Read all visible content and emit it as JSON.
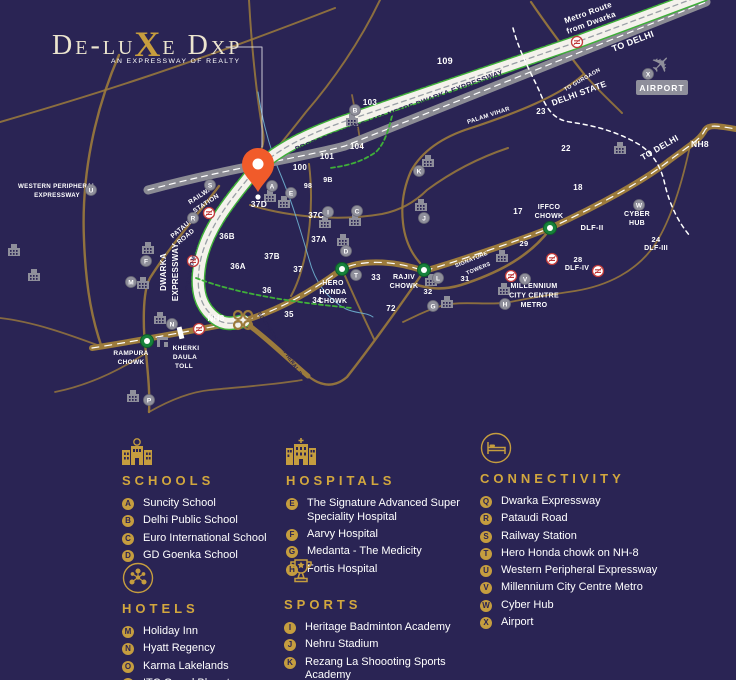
{
  "logo": {
    "part1": "De-lu",
    "accent": "X",
    "part2": "e Dxp",
    "tagline": "AN EXPRESSWAY OF REALTY"
  },
  "legend": {
    "sections": [
      {
        "id": "schools",
        "icon": "school-icon",
        "title": "SCHOOLS",
        "items": [
          {
            "letter": "A",
            "label": "Suncity School"
          },
          {
            "letter": "B",
            "label": "Delhi Public School"
          },
          {
            "letter": "C",
            "label": "Euro International School"
          },
          {
            "letter": "D",
            "label": "GD Goenka School"
          }
        ]
      },
      {
        "id": "hospitals",
        "icon": "hospital-icon",
        "title": "HOSPITALS",
        "items": [
          {
            "letter": "E",
            "label": "The Signature Advanced Super Speciality Hospital"
          },
          {
            "letter": "F",
            "label": "Aarvy Hospital"
          },
          {
            "letter": "G",
            "label": "Medanta - The Medicity"
          },
          {
            "letter": "H",
            "label": "Fortis Hospital"
          }
        ]
      },
      {
        "id": "connectivity",
        "icon": "bed-icon",
        "title": "CONNECTIVITY",
        "items": [
          {
            "letter": "Q",
            "label": "Dwarka Expressway"
          },
          {
            "letter": "R",
            "label": "Pataudi Road"
          },
          {
            "letter": "S",
            "label": "Railway Station"
          },
          {
            "letter": "T",
            "label": "Hero Honda chowk on NH-8"
          },
          {
            "letter": "U",
            "label": "Western Peripheral Expressway"
          },
          {
            "letter": "V",
            "label": "Millennium City Centre Metro"
          },
          {
            "letter": "W",
            "label": "Cyber Hub"
          },
          {
            "letter": "X",
            "label": "Airport"
          }
        ]
      },
      {
        "id": "hotels",
        "icon": "network-icon",
        "title": "HOTELS",
        "items": [
          {
            "letter": "M",
            "label": "Holiday Inn"
          },
          {
            "letter": "N",
            "label": "Hyatt Regency"
          },
          {
            "letter": "O",
            "label": "Karma Lakelands"
          },
          {
            "letter": "P",
            "label": "ITC Grand Bharat"
          }
        ]
      },
      {
        "id": "sports",
        "icon": "trophy-icon",
        "title": "SPORTS",
        "items": [
          {
            "letter": "I",
            "label": "Heritage Badminton Academy"
          },
          {
            "letter": "J",
            "label": "Nehru Stadium"
          },
          {
            "letter": "K",
            "label": "Rezang La Shoooting Sports Academy"
          },
          {
            "letter": "L",
            "label": "Tau Devi Lal Sports Complex"
          }
        ]
      }
    ]
  },
  "map": {
    "colors": {
      "background": "#2a2454",
      "gold_road": "#9c7b3c",
      "accent_gold": "#c59d3f",
      "heading_gold": "#d2a73e",
      "white_road": "#f4f2ec",
      "grey_road": "#8b8b94",
      "green_dash": "#3faf39",
      "pin_orange": "#f15b2a",
      "metro_red": "#c03a3a",
      "marker_grey": "#8f8f9b",
      "navy_text": "#2a2454",
      "rail_blue": "#6fb3d2",
      "node_green": "#17823b",
      "white": "#ffffff"
    },
    "pin": {
      "x": 258,
      "y": 166,
      "label": "37D"
    },
    "airport": {
      "x": 662,
      "y": 88,
      "label": "AIRPORT"
    },
    "labels": [
      {
        "t": "Metro Route",
        "x": 589,
        "y": 15,
        "r": -20,
        "s": 8
      },
      {
        "t": "from Dwarka",
        "x": 592,
        "y": 25,
        "r": -20,
        "s": 8
      },
      {
        "t": "TO DELHI",
        "x": 634,
        "y": 44,
        "r": -21,
        "s": 9
      },
      {
        "t": "TO GURGAON",
        "x": 583,
        "y": 81,
        "r": -30,
        "s": 5.5
      },
      {
        "t": "DELHI STATE",
        "x": 580,
        "y": 96,
        "r": -20,
        "s": 8.5
      },
      {
        "t": "PALAM VIHAR",
        "x": 489,
        "y": 117,
        "r": -18,
        "s": 6
      },
      {
        "t": "PROPOSED METRO / 150 METRE DWARKA EXPRESSWAY",
        "x": 400,
        "y": 113,
        "r": -20.5,
        "s": 7.5,
        "c": "n"
      },
      {
        "t": "TO DELHI",
        "x": 661,
        "y": 150,
        "r": -30,
        "s": 8.5
      },
      {
        "t": "NH8",
        "x": 700,
        "y": 147,
        "s": 8.5
      },
      {
        "t": "109",
        "x": 445,
        "y": 64,
        "s": 9
      },
      {
        "t": "23",
        "x": 541,
        "y": 114,
        "s": 8
      },
      {
        "t": "22",
        "x": 566,
        "y": 151,
        "s": 8
      },
      {
        "t": "103",
        "x": 370,
        "y": 105,
        "s": 8
      },
      {
        "t": "104",
        "x": 357,
        "y": 149,
        "s": 8
      },
      {
        "t": "101",
        "x": 327,
        "y": 159,
        "s": 8
      },
      {
        "t": "100",
        "x": 300,
        "y": 170,
        "s": 8
      },
      {
        "t": "9B",
        "x": 328,
        "y": 182,
        "s": 7
      },
      {
        "t": "98",
        "x": 308,
        "y": 188,
        "s": 7
      },
      {
        "t": "18",
        "x": 578,
        "y": 190,
        "s": 8
      },
      {
        "t": "17",
        "x": 518,
        "y": 214,
        "s": 8
      },
      {
        "t": "29",
        "x": 524,
        "y": 246,
        "s": 7.5
      },
      {
        "t": "DLF-II",
        "x": 592,
        "y": 230,
        "s": 7.5
      },
      {
        "t": "CYBER",
        "x": 637,
        "y": 216,
        "s": 7
      },
      {
        "t": "HUB",
        "x": 637,
        "y": 225,
        "s": 7
      },
      {
        "t": "24",
        "x": 656,
        "y": 242,
        "s": 7.5
      },
      {
        "t": "DLF-III",
        "x": 656,
        "y": 250,
        "s": 7
      },
      {
        "t": "28",
        "x": 578,
        "y": 262,
        "s": 7.5
      },
      {
        "t": "DLF-IV",
        "x": 577,
        "y": 270,
        "s": 7
      },
      {
        "t": "MILLENNIUM",
        "x": 534,
        "y": 288,
        "s": 7
      },
      {
        "t": "CITY CENTRE",
        "x": 534,
        "y": 297.5,
        "s": 7
      },
      {
        "t": "METRO",
        "x": 534,
        "y": 307,
        "s": 7
      },
      {
        "t": "SIGNATURE",
        "x": 472,
        "y": 261,
        "r": -22,
        "s": 5.5
      },
      {
        "t": "TOWERS",
        "x": 479,
        "y": 270,
        "r": -22,
        "s": 5.5
      },
      {
        "t": "31",
        "x": 465,
        "y": 281,
        "s": 7.5
      },
      {
        "t": "32",
        "x": 428,
        "y": 294,
        "s": 7.5
      },
      {
        "t": "33",
        "x": 376,
        "y": 280,
        "s": 8
      },
      {
        "t": "72",
        "x": 391,
        "y": 311,
        "s": 8
      },
      {
        "t": "RAJIV",
        "x": 404,
        "y": 279,
        "s": 7
      },
      {
        "t": "CHOWK",
        "x": 404,
        "y": 288,
        "s": 7
      },
      {
        "t": "HERO",
        "x": 333,
        "y": 285,
        "s": 7
      },
      {
        "t": "HONDA",
        "x": 333,
        "y": 294,
        "s": 7
      },
      {
        "t": "CHOWK",
        "x": 333,
        "y": 303,
        "s": 7
      },
      {
        "t": "IFFCO",
        "x": 549,
        "y": 209,
        "s": 7
      },
      {
        "t": "CHOWK",
        "x": 549,
        "y": 218,
        "s": 7
      },
      {
        "t": "36B",
        "x": 227,
        "y": 239,
        "s": 8
      },
      {
        "t": "37B",
        "x": 272,
        "y": 259,
        "s": 8
      },
      {
        "t": "36A",
        "x": 238,
        "y": 269,
        "s": 8
      },
      {
        "t": "37",
        "x": 298,
        "y": 272,
        "s": 8
      },
      {
        "t": "36",
        "x": 267,
        "y": 293,
        "s": 8
      },
      {
        "t": "34",
        "x": 317,
        "y": 303,
        "s": 8
      },
      {
        "t": "35",
        "x": 289,
        "y": 317,
        "s": 8
      },
      {
        "t": "37A",
        "x": 319,
        "y": 242,
        "s": 8
      },
      {
        "t": "37C",
        "x": 316,
        "y": 218,
        "s": 8
      },
      {
        "t": "NH8",
        "x": 216,
        "y": 321,
        "s": 8
      },
      {
        "t": "SOUTHERN PERIPHERAL ROAD",
        "x": 282,
        "y": 350,
        "r": 56,
        "s": 5.2,
        "c": "n"
      },
      {
        "t": "KHERKI",
        "x": 186,
        "y": 350,
        "s": 6.5
      },
      {
        "t": "DAULA",
        "x": 185,
        "y": 359,
        "s": 6.5
      },
      {
        "t": "TOLL",
        "x": 184,
        "y": 368,
        "s": 6.5
      },
      {
        "t": "RAMPURA",
        "x": 131,
        "y": 355,
        "s": 6.5
      },
      {
        "t": "CHOWK",
        "x": 131,
        "y": 364,
        "s": 6.5
      },
      {
        "t": "DWARKA",
        "x": 166,
        "y": 272,
        "r": -90,
        "s": 8
      },
      {
        "t": "EXPRESSWAY",
        "x": 178,
        "y": 272,
        "r": -90,
        "s": 8
      },
      {
        "t": "PROPOSED METRO",
        "x": 193,
        "y": 267,
        "r": -78,
        "s": 5,
        "c": "n"
      },
      {
        "t": "RAILWAY",
        "x": 203,
        "y": 196,
        "r": -33,
        "s": 6.5
      },
      {
        "t": "STATION",
        "x": 207,
        "y": 205,
        "r": -33,
        "s": 6.5
      },
      {
        "t": "PATAUDI",
        "x": 184,
        "y": 229,
        "r": -40,
        "s": 6.5
      },
      {
        "t": "ROAD",
        "x": 187,
        "y": 238,
        "r": -40,
        "s": 6.5
      },
      {
        "t": "WESTERN PERIPHERAL",
        "x": 57,
        "y": 188,
        "s": 6.2
      },
      {
        "t": "EXPRESSWAY",
        "x": 57,
        "y": 197,
        "s": 6.2
      },
      {
        "t": "37D",
        "x": 259,
        "y": 207,
        "s": 8.5
      }
    ],
    "markers": [
      {
        "l": "A",
        "x": 272,
        "y": 186
      },
      {
        "l": "B",
        "x": 355,
        "y": 110
      },
      {
        "l": "C",
        "x": 357,
        "y": 211
      },
      {
        "l": "D",
        "x": 346,
        "y": 251
      },
      {
        "l": "E",
        "x": 291,
        "y": 193
      },
      {
        "l": "F",
        "x": 146,
        "y": 261
      },
      {
        "l": "G",
        "x": 433,
        "y": 306
      },
      {
        "l": "H",
        "x": 505,
        "y": 304
      },
      {
        "l": "I",
        "x": 328,
        "y": 212
      },
      {
        "l": "J",
        "x": 424,
        "y": 218
      },
      {
        "l": "K",
        "x": 419,
        "y": 171
      },
      {
        "l": "L",
        "x": 438,
        "y": 278
      },
      {
        "l": "M",
        "x": 131,
        "y": 282
      },
      {
        "l": "N",
        "x": 172,
        "y": 324
      },
      {
        "l": "P",
        "x": 149,
        "y": 400
      },
      {
        "l": "R",
        "x": 193,
        "y": 218
      },
      {
        "l": "S",
        "x": 210,
        "y": 185
      },
      {
        "l": "T",
        "x": 356,
        "y": 275
      },
      {
        "l": "U",
        "x": 91,
        "y": 190
      },
      {
        "l": "V",
        "x": 525,
        "y": 279
      },
      {
        "l": "W",
        "x": 639,
        "y": 205
      },
      {
        "l": "X",
        "x": 648,
        "y": 74
      }
    ],
    "green_nodes": [
      {
        "x": 147,
        "y": 341
      },
      {
        "x": 342,
        "y": 269
      },
      {
        "x": 424,
        "y": 270
      },
      {
        "x": 550,
        "y": 228
      }
    ],
    "metro_icons": [
      {
        "x": 577,
        "y": 42
      },
      {
        "x": 209,
        "y": 213
      },
      {
        "x": 193,
        "y": 261
      },
      {
        "x": 199,
        "y": 329
      },
      {
        "x": 511,
        "y": 276
      },
      {
        "x": 552,
        "y": 259
      },
      {
        "x": 598,
        "y": 271
      }
    ],
    "buildings": [
      {
        "x": 352,
        "y": 123
      },
      {
        "x": 270,
        "y": 199
      },
      {
        "x": 284,
        "y": 205
      },
      {
        "x": 355,
        "y": 223
      },
      {
        "x": 325,
        "y": 225
      },
      {
        "x": 343,
        "y": 243
      },
      {
        "x": 428,
        "y": 164
      },
      {
        "x": 421,
        "y": 208
      },
      {
        "x": 620,
        "y": 151
      },
      {
        "x": 502,
        "y": 259
      },
      {
        "x": 504,
        "y": 292
      },
      {
        "x": 447,
        "y": 305
      },
      {
        "x": 143,
        "y": 286
      },
      {
        "x": 148,
        "y": 251
      },
      {
        "x": 160,
        "y": 321
      },
      {
        "x": 133,
        "y": 399
      },
      {
        "x": 14,
        "y": 253
      },
      {
        "x": 34,
        "y": 278
      },
      {
        "x": 431,
        "y": 283
      }
    ]
  }
}
